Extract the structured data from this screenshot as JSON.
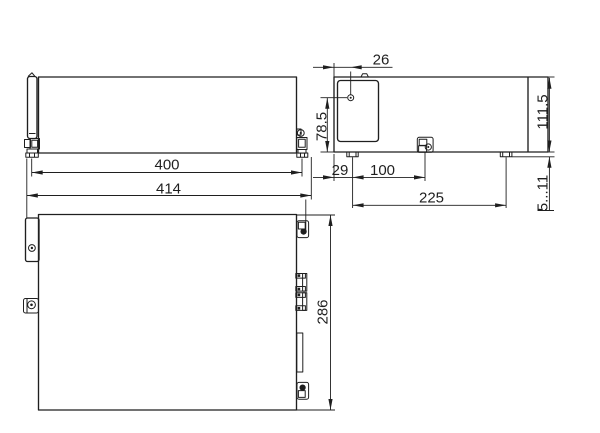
{
  "drawing": {
    "background_color": "#ffffff",
    "line_color": "#1f1f1f",
    "dimensions": {
      "mounting_width": "400",
      "overall_width": "414",
      "hole_offset_x": "26",
      "hole_offset_y": "78.5",
      "foot_inset": "29",
      "foot_to_clamp": "100",
      "foot_pitch": "225",
      "body_height": "111.5",
      "foot_height_range": "5...11",
      "body_depth": "286"
    }
  }
}
